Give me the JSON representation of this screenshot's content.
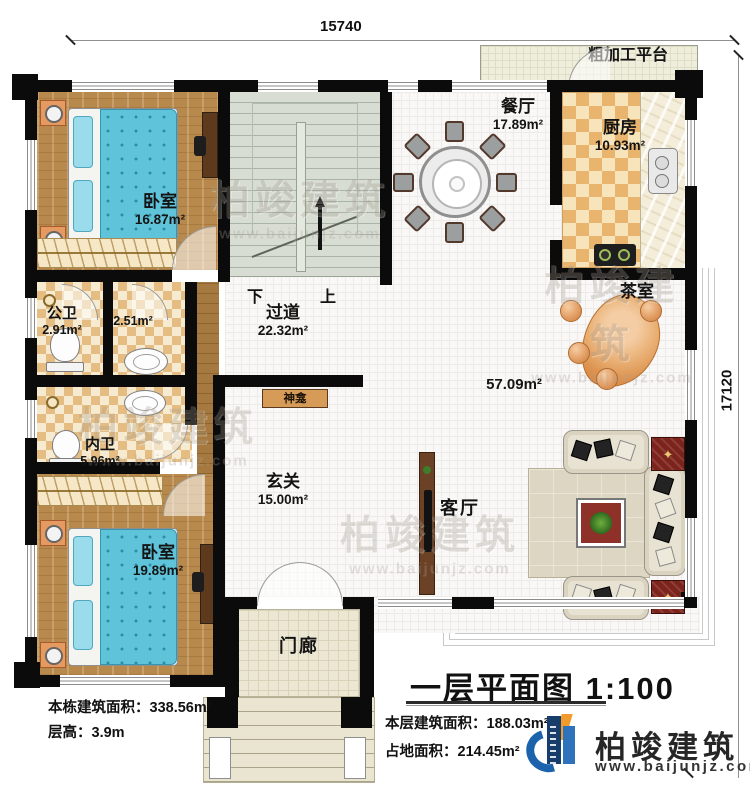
{
  "dimensions": {
    "top": "15740",
    "right": "17120"
  },
  "rooms": {
    "bedroom1": {
      "name": "卧室",
      "area": "16.87m²"
    },
    "bedroom2": {
      "name": "卧室",
      "area": "19.89m²"
    },
    "dining": {
      "name": "餐厅",
      "area": "17.89m²"
    },
    "kitchen": {
      "name": "厨房",
      "area": "10.93m²"
    },
    "platform": {
      "name": "粗加工平台"
    },
    "public_bath": {
      "name": "公卫",
      "area": "2.91m²"
    },
    "washroom": {
      "area": "2.51m²"
    },
    "inner_bath": {
      "name": "内卫",
      "area": "5.96m²"
    },
    "corridor": {
      "name": "过道",
      "area": "22.32m²"
    },
    "foyer": {
      "name": "玄关",
      "area": "15.00m²"
    },
    "shrine": {
      "name": "神龛"
    },
    "tea_room": {
      "name": "茶室"
    },
    "living_area": {
      "area": "57.09m²"
    },
    "living_room": {
      "name": "客厅"
    },
    "porch": {
      "name": "门廊"
    }
  },
  "stairs": {
    "down": "下",
    "up": "上"
  },
  "notes": {
    "building_area_label": "本栋建筑面积：338.56m²",
    "floor_height_label": "层高：3.9m",
    "floor_area_label": "本层建筑面积：188.03m²",
    "footprint_label": "占地面积：214.45m²"
  },
  "title": {
    "text": "一层平面图 1:100"
  },
  "logo": {
    "name": "柏竣建筑",
    "url": "www.baijunjz.com"
  },
  "watermark": {
    "text": "柏竣建筑",
    "url": "www.baijunjz.com"
  },
  "colors": {
    "wall": "#0b0b0b",
    "logo_blue": "#1b63ad",
    "logo_navy": "#173e6b",
    "logo_orange": "#f29b2d"
  }
}
